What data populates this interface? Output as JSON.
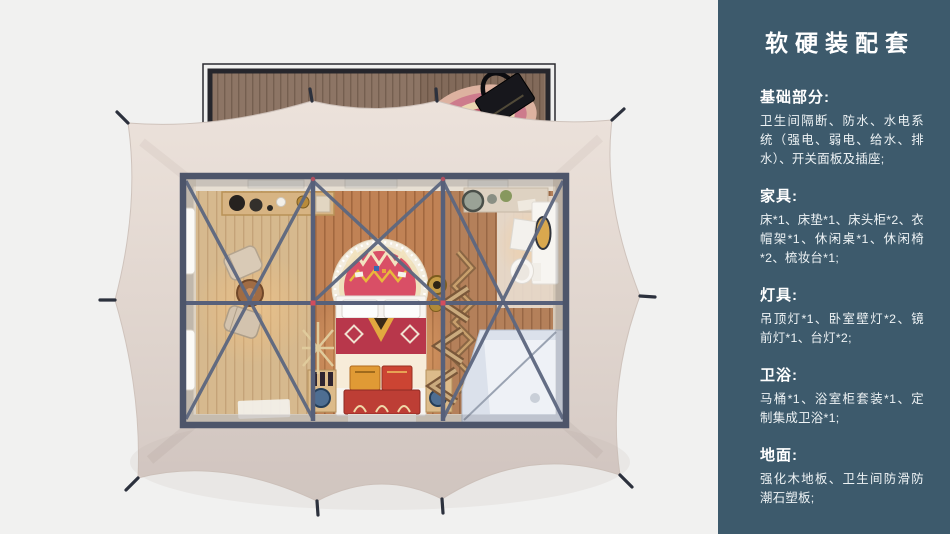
{
  "panel": {
    "title": "软硬装配套",
    "sections": [
      {
        "heading": "基础部分:",
        "body": "卫生间隔断、防水、水电系统（强电、弱电、给水、排水）、开关面板及插座;"
      },
      {
        "heading": "家具:",
        "body": "床*1、床垫*1、床头柜*2、衣帽架*1、休闲桌*1、休闲椅*2、梳妆台*1;"
      },
      {
        "heading": "灯具:",
        "body": "吊顶灯*1、卧室壁灯*2、镜前灯*1、台灯*2;"
      },
      {
        "heading": "卫浴:",
        "body": "马桶*1、浴室柜套装*1、定制集成卫浴*1;"
      },
      {
        "heading": "地面:",
        "body": "强化木地板、卫生间防滑防潮石塑板;"
      }
    ],
    "colors": {
      "background": "#3d5a6c",
      "text": "#ffffff"
    }
  },
  "scene": {
    "colors": {
      "page_background": "#f1f1f0",
      "tent_canvas": "#e2d7d0",
      "steel_frame": "#57607a",
      "deck_wood": "#8d7565",
      "bedroom_floor": "#c08255",
      "accent_red": "#d44d5c"
    }
  }
}
